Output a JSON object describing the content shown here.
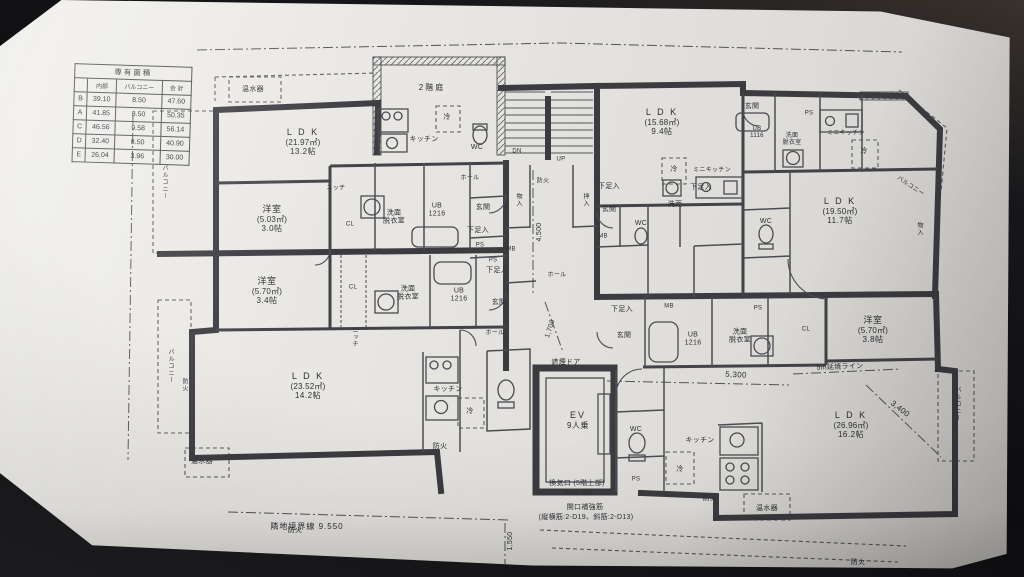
{
  "area_table": {
    "title": "専有面積",
    "col_headers": [
      "内部",
      "バルコニー",
      "合 計"
    ],
    "rows": [
      {
        "unit": "B",
        "inner": "39.10",
        "balcony": "8.50",
        "total": "47.60"
      },
      {
        "unit": "A",
        "inner": "41.85",
        "balcony": "8.50",
        "total": "50.35"
      },
      {
        "unit": "C",
        "inner": "46.56",
        "balcony": "9.58",
        "total": "56.14"
      },
      {
        "unit": "D",
        "inner": "32.40",
        "balcony": "8.50",
        "total": "40.90"
      },
      {
        "unit": "E",
        "inner": "26.04",
        "balcony": "3.96",
        "total": "30.00"
      }
    ]
  },
  "rooms": [
    {
      "name": "L D K",
      "area": "(21.97㎡)",
      "size": "13.2帖"
    },
    {
      "name": "L D K",
      "area": "(15.68㎡)",
      "size": "9.4帖"
    },
    {
      "name": "L D K",
      "area": "(19.50㎡)",
      "size": "11.7帖"
    },
    {
      "name": "L D K",
      "area": "(23.52㎡)",
      "size": "14.2帖"
    },
    {
      "name": "L D K",
      "area": "(26.96㎡)",
      "size": "16.2帖"
    },
    {
      "name": "洋室",
      "area": "(5.03㎡)",
      "size": "3.0帖"
    },
    {
      "name": "洋室",
      "area": "(5.70㎡)",
      "size": "3.4帖"
    },
    {
      "name": "洋室",
      "area": "(5.70㎡)",
      "size": "3.8帖"
    }
  ],
  "special": {
    "roof_garden": "2階庭",
    "ev_name": "EV",
    "ev_capacity": "9人乗",
    "smoke_door": "遮煙ドア"
  },
  "fixtures": {
    "water_heater": "温水器",
    "kitchen": "キッチン",
    "mini_kitchen": "ミニキッチン",
    "fridge": "冷",
    "wc": "WC",
    "washroom": "洗面",
    "dressing": "脱衣室",
    "ub": "UB",
    "ub_1216": "1216",
    "ub_1116": "1116",
    "entrance": "玄関",
    "shoe_box": "下足入",
    "hall": "ホール",
    "closet": "CL",
    "storage": "物入",
    "oshiire": "押入",
    "ps": "PS",
    "mb": "MB",
    "niche": "ニッチ",
    "balcony": "バルコニー",
    "fire": "防火",
    "down": "DN",
    "up": "UP"
  },
  "dimensions": {
    "hall_depth": "4,500",
    "d1700": "1,700",
    "d5300": "5,300",
    "d3400": "3,400",
    "d1550": "1,550",
    "boundary": "隣地境界線 9.550",
    "fire_spread_line": "5m延焼ライン"
  },
  "notes": {
    "vent": "換気口 (5階上部)",
    "vent_size": "400×400",
    "reinforcement": "開口補強筋",
    "reinforcement_detail": "(縦横筋:2-D19、斜筋:2-D13)"
  }
}
